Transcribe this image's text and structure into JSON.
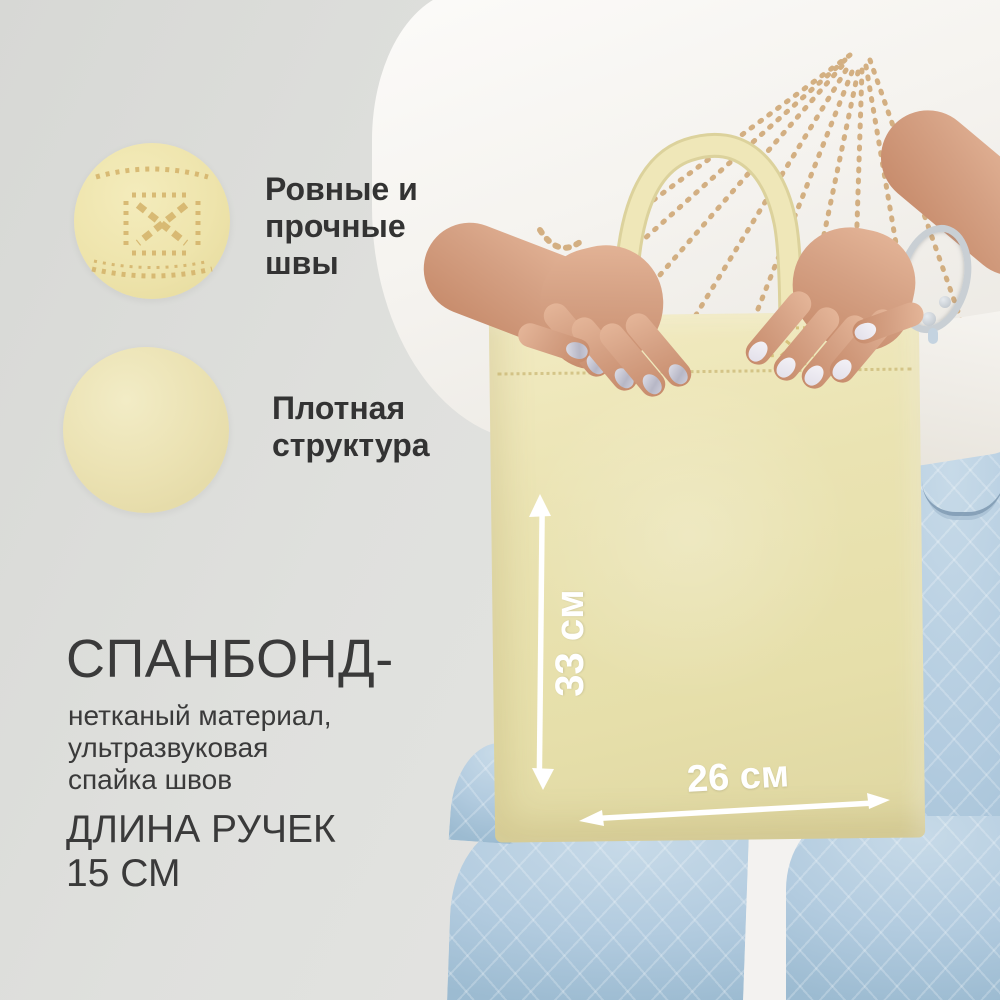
{
  "annotations": {
    "seams_label": "Ровные и\nпрочные\nшвы",
    "texture_label": "Плотная\nструктура"
  },
  "description": {
    "material_title": "СПАНБОНД-",
    "material_details": "нетканый материал,\nультразвуковая\nспайка швов",
    "handle_info": "ДЛИНА РУЧЕК\n15 СМ"
  },
  "dimensions": {
    "bag_height": "33 см",
    "bag_width": "26 см"
  },
  "colors": {
    "bag_cream": "#eae3b2",
    "background_gray": "#dfe0dd",
    "jeans_blue": "#b4cce0",
    "tshirt_white": "#f5f3ef",
    "skin": "#d5a184",
    "print_gold": "#c8995e",
    "stitch_gold": "#d4b269",
    "text_dark": "#333333",
    "dimension_white": "#ffffff"
  }
}
